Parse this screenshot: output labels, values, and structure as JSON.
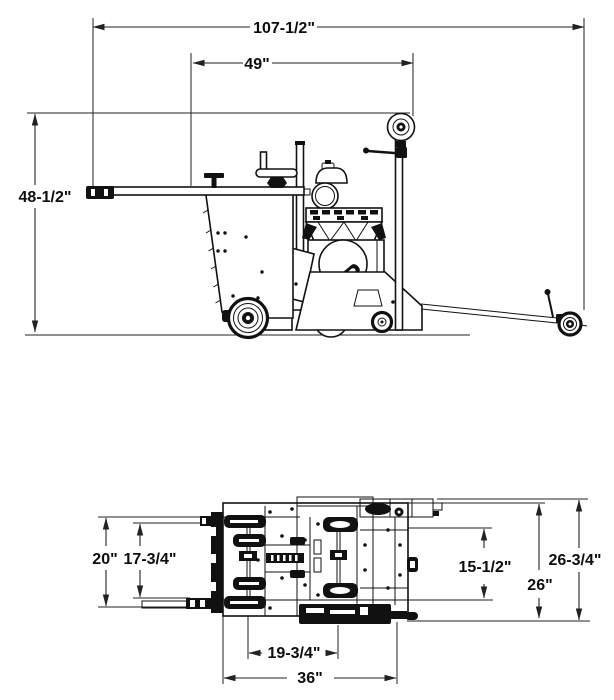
{
  "title": "Walk-behind concrete saw dimensional drawing",
  "colors": {
    "line": "#111111",
    "dimension": "#222222",
    "background": "#ffffff"
  },
  "side_view": {
    "overall_length": "107-1/2\"",
    "body_length": "49\"",
    "overall_height": "48-1/2\""
  },
  "plan_view": {
    "front_track_width": "20\"",
    "front_inner_width": "17-3/4\"",
    "rear_inner_width": "15-1/2\"",
    "rear_width": "26\"",
    "rear_overall_width": "26-3/4\"",
    "axle_spacing": "19-3/4\"",
    "base_length": "36\""
  }
}
